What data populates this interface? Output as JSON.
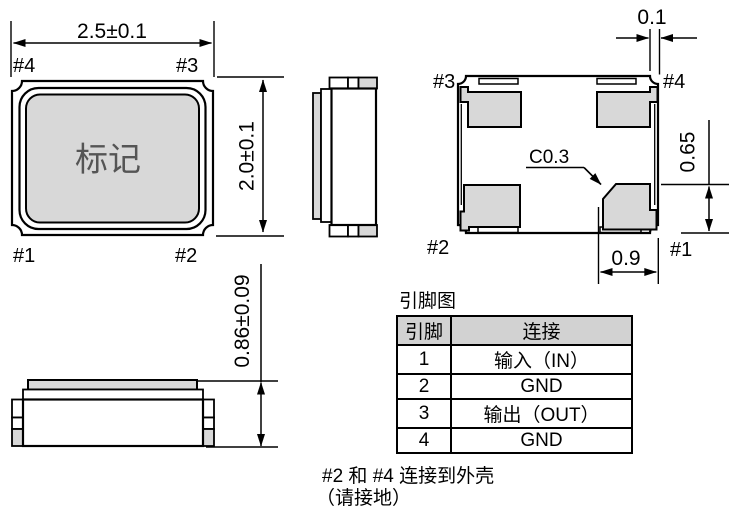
{
  "colors": {
    "package_fill": "#d8d8d8",
    "table_header_fill": "#d2d2d2",
    "line": "#000000",
    "marking_text": "#555555"
  },
  "top_view": {
    "marking": "标记",
    "width_dim": "2.5±0.1",
    "height_dim": "2.0±0.1",
    "pin_top_left": "#4",
    "pin_top_right": "#3",
    "pin_bottom_left": "#1",
    "pin_bottom_right": "#2"
  },
  "side_view": {
    "height_dim": "0.86±0.09"
  },
  "bottom_view": {
    "pin_top_left": "#3",
    "pin_top_right": "#4",
    "pin_bottom_left": "#2",
    "pin_bottom_right": "#1",
    "corner_gap_dim": "0.1",
    "pad_width_dim": "0.9",
    "pad_height_dim": "0.65",
    "chamfer_label": "C0.3"
  },
  "pin_table": {
    "title": "引脚图",
    "headers": {
      "pin": "引脚",
      "connection": "连接"
    },
    "rows": [
      {
        "pin": "1",
        "connection": "输入（IN）"
      },
      {
        "pin": "2",
        "connection": "GND"
      },
      {
        "pin": "3",
        "connection": "输出（OUT）"
      },
      {
        "pin": "4",
        "connection": "GND"
      }
    ]
  },
  "note": {
    "line1": "#2 和 #4 连接到外壳",
    "line2": "（请接地）"
  }
}
